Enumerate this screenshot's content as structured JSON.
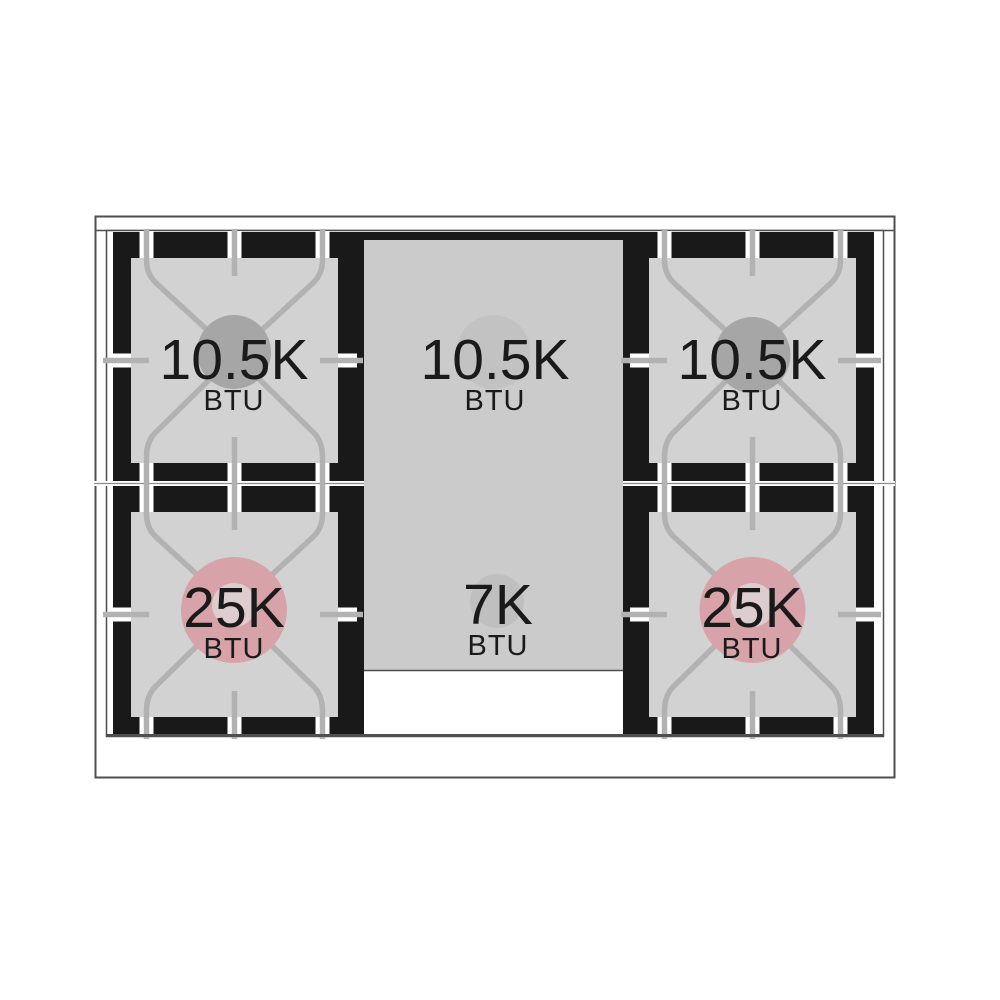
{
  "diagram": {
    "type": "gas-range-cooktop-btu-diagram",
    "description": "Top view of a 5-burner gas range top with BTU ratings",
    "burners": [
      {
        "id": "top-left",
        "value": "10.5K",
        "unit": "BTU",
        "circle_color": "#a6a6a6"
      },
      {
        "id": "top-center",
        "value": "10.5K",
        "unit": "BTU",
        "circle_color": "#c2c2c2"
      },
      {
        "id": "top-right",
        "value": "10.5K",
        "unit": "BTU",
        "circle_color": "#a6a6a6"
      },
      {
        "id": "bottom-left",
        "value": "25K",
        "unit": "BTU",
        "circle_color": "#d8a3a8",
        "inner_ring_color": "#ddcdce"
      },
      {
        "id": "bottom-center",
        "value": "7K",
        "unit": "BTU",
        "circle_color": "#bfbfbf"
      },
      {
        "id": "bottom-right",
        "value": "25K",
        "unit": "BTU",
        "circle_color": "#d8a3a8",
        "inner_ring_color": "#ddcdce"
      }
    ],
    "colors": {
      "background": "#ffffff",
      "outline_gray": "#4f4f4f",
      "grate_black": "#191919",
      "burner_bed_gray": "#d2d2d2",
      "griddle_gray": "#cbcbcb",
      "grate_bar_gray": "#b2b2b2",
      "high_power_pink": "#d8a3a8",
      "text": "#1a1a1a"
    }
  }
}
